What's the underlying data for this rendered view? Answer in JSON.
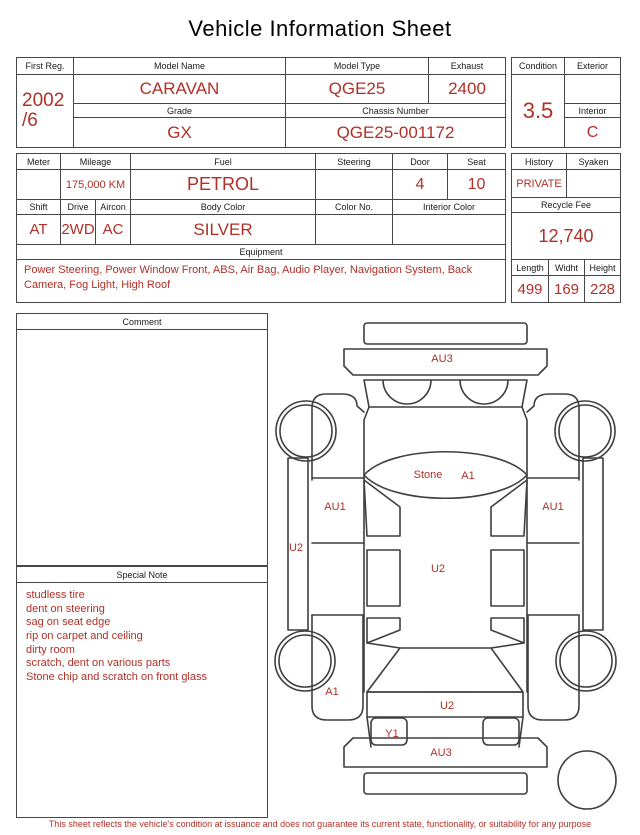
{
  "title": "Vehicle Information Sheet",
  "colors": {
    "accent": "#b03028",
    "line": "#474747"
  },
  "info": {
    "first_reg": {
      "label": "First Reg.",
      "value_line1": "2002",
      "value_line2": "/6"
    },
    "model_name": {
      "label": "Model Name",
      "value": "CARAVAN"
    },
    "model_type": {
      "label": "Model Type",
      "value": "QGE25"
    },
    "exhaust": {
      "label": "Exhaust",
      "value": "2400"
    },
    "grade": {
      "label": "Grade",
      "value": "GX"
    },
    "chassis_number": {
      "label": "Chassis Number",
      "value": "QGE25-001172"
    },
    "condition": {
      "label": "Condition",
      "value": "3.5"
    },
    "exterior": {
      "label": "Exterior",
      "value": ""
    },
    "interior": {
      "label": "Interior",
      "value": "C"
    },
    "meter": {
      "label": "Meter",
      "value": ""
    },
    "mileage": {
      "label": "Mileage",
      "value": "175,000 KM"
    },
    "fuel": {
      "label": "Fuel",
      "value": "PETROL"
    },
    "steering": {
      "label": "Steering",
      "value": ""
    },
    "door": {
      "label": "Door",
      "value": "4"
    },
    "seat": {
      "label": "Seat",
      "value": "10"
    },
    "shift": {
      "label": "Shift",
      "value": "AT"
    },
    "drive": {
      "label": "Drive",
      "value": "2WD"
    },
    "aircon": {
      "label": "Aircon",
      "value": "AC"
    },
    "body_color": {
      "label": "Body Color",
      "value": "SILVER"
    },
    "color_no": {
      "label": "Color No.",
      "value": ""
    },
    "interior_color": {
      "label": "Interior Color",
      "value": ""
    },
    "history": {
      "label": "History",
      "value": "PRIVATE"
    },
    "syaken": {
      "label": "Syaken",
      "value": ""
    },
    "recycle_fee": {
      "label": "Recycle Fee",
      "value": "12,740"
    },
    "equipment": {
      "label": "Equipment",
      "value": "Power Steering, Power Window  Front, ABS, Air Bag, Audio Player, Navigation System, Back Camera, Fog Light, High Roof"
    },
    "length": {
      "label": "Length",
      "value": "499"
    },
    "widht": {
      "label": "Widht",
      "value": "169"
    },
    "height": {
      "label": "Height",
      "value": "228"
    }
  },
  "comment": {
    "label": "Comment",
    "text": ""
  },
  "special_note": {
    "label": "Special Note",
    "lines": [
      "studless tire",
      "dent on steering",
      "sag on seat edge",
      "rip on carpet and ceiling",
      "dirty room",
      "scratch, dent on various parts",
      "Stone chip and scratch on front glass"
    ]
  },
  "diagram": {
    "front_panel": "AU3",
    "front_glass_note": "Stone",
    "front_glass_grade": "A1",
    "left_side": "AU1",
    "right_side": "AU1",
    "left_rocker": "U2",
    "roof": "U2",
    "rear_left_fender": "A1",
    "tailgate": "U2",
    "rear_corner": "Y1",
    "rear_panel": "AU3"
  },
  "footer": "This sheet reflects the vehicle's condition at issuance and does not guarantee its current state, functionality, or suitability for any purpose"
}
